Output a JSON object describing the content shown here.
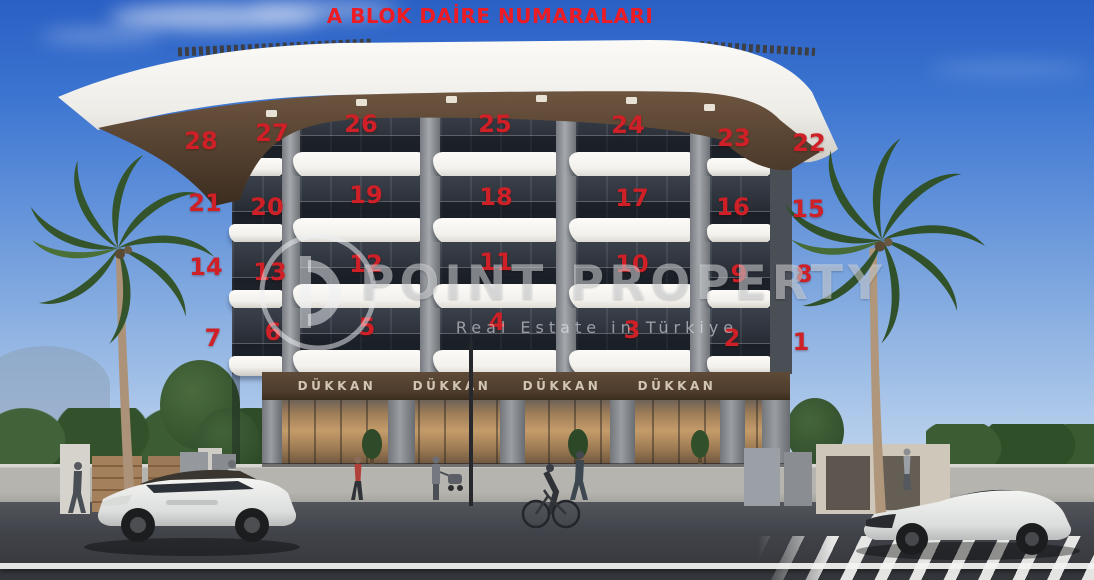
{
  "title": {
    "text": "A BLOK DAİRE NUMARALARI"
  },
  "watermark": {
    "brand": "POINT PROPERTY",
    "tagline": "Real Estate in Türkiye"
  },
  "shops": {
    "sign_labels": [
      "DÜKKAN",
      "DÜKKAN",
      "DÜKKAN",
      "DÜKKAN"
    ]
  },
  "apartment_numbers": [
    {
      "label": "28",
      "x": 201,
      "y": 141
    },
    {
      "label": "27",
      "x": 272,
      "y": 133
    },
    {
      "label": "26",
      "x": 361,
      "y": 124
    },
    {
      "label": "25",
      "x": 495,
      "y": 124
    },
    {
      "label": "24",
      "x": 628,
      "y": 125
    },
    {
      "label": "23",
      "x": 734,
      "y": 138
    },
    {
      "label": "22",
      "x": 809,
      "y": 143
    },
    {
      "label": "21",
      "x": 205,
      "y": 203
    },
    {
      "label": "20",
      "x": 267,
      "y": 207
    },
    {
      "label": "19",
      "x": 366,
      "y": 195
    },
    {
      "label": "18",
      "x": 496,
      "y": 197
    },
    {
      "label": "17",
      "x": 632,
      "y": 198
    },
    {
      "label": "16",
      "x": 733,
      "y": 207
    },
    {
      "label": "15",
      "x": 808,
      "y": 209
    },
    {
      "label": "14",
      "x": 206,
      "y": 267
    },
    {
      "label": "13",
      "x": 270,
      "y": 272
    },
    {
      "label": "12",
      "x": 366,
      "y": 264
    },
    {
      "label": "11",
      "x": 496,
      "y": 262
    },
    {
      "label": "10",
      "x": 632,
      "y": 264
    },
    {
      "label": "9",
      "x": 739,
      "y": 274
    },
    {
      "label": "8",
      "x": 804,
      "y": 274
    },
    {
      "label": "7",
      "x": 213,
      "y": 338
    },
    {
      "label": "6",
      "x": 273,
      "y": 332
    },
    {
      "label": "5",
      "x": 367,
      "y": 327
    },
    {
      "label": "4",
      "x": 497,
      "y": 322
    },
    {
      "label": "3",
      "x": 632,
      "y": 330
    },
    {
      "label": "2",
      "x": 732,
      "y": 338
    },
    {
      "label": "1",
      "x": 801,
      "y": 342
    }
  ],
  "colors": {
    "title_red": "#ed1c24",
    "number_red": "#cf2027",
    "sky_top": "#2a5fc4",
    "balcony_white": "#f3f1ec",
    "fascia_brown": "#4e3c2c"
  }
}
